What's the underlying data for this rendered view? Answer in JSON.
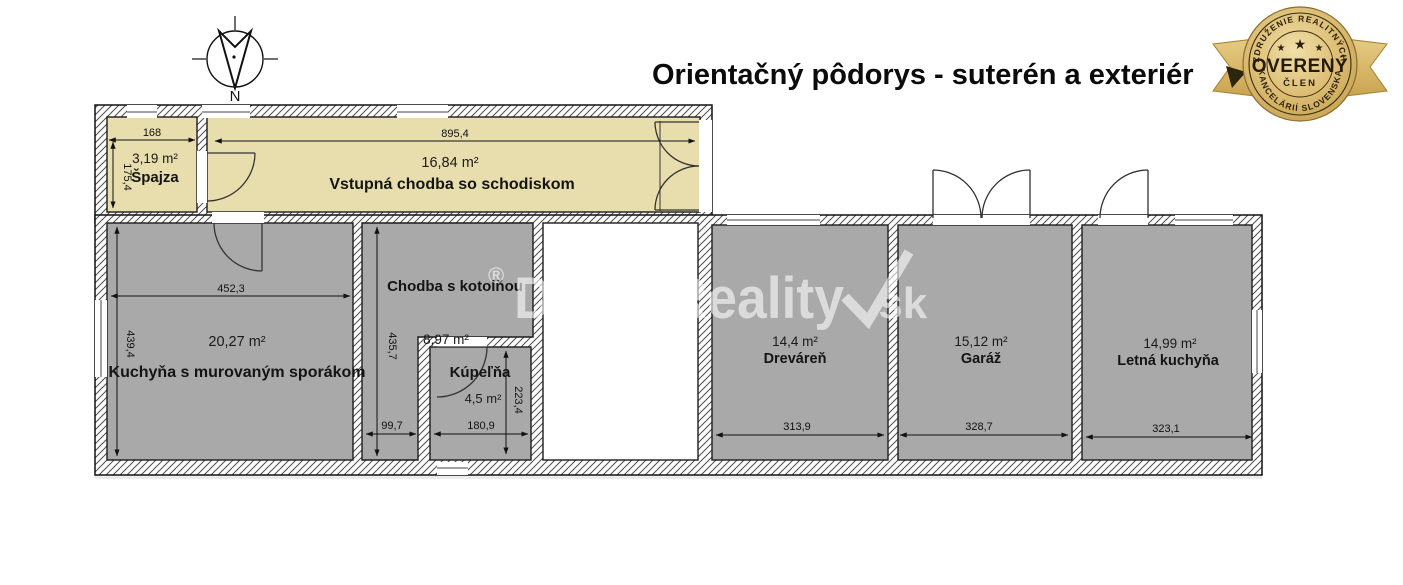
{
  "title": "Orientačný pôdorys - suterén a exteriér",
  "compass": {
    "north_label": "N"
  },
  "watermark": {
    "registered": "®",
    "text": "DobréReality",
    "suffix": ".sk"
  },
  "badge": {
    "top_arc": "ZDRUŽENIE REALITNÝCH",
    "bottom_arc": "KANCELÁRIÍ SLOVENSKA",
    "main_label": "OVERENÝ",
    "sub_label": "ČLEN",
    "stars": [
      "★",
      "★",
      "★"
    ]
  },
  "rooms": {
    "spajza": {
      "name": "Špajza",
      "area": "3,19 m²",
      "width": "168",
      "height": "175,4"
    },
    "hall": {
      "name": "Vstupná chodba so schodiskom",
      "area": "16,84 m²",
      "width": "895,4"
    },
    "kitchen": {
      "name": "Kuchyňa s murovaným sporákom",
      "area": "20,27 m²",
      "width": "452,3",
      "height": "439,4"
    },
    "chodba": {
      "name": "Chodba s kotolňou",
      "area": "8,97 m²",
      "width": "99,7",
      "height": "435,7"
    },
    "kupelna": {
      "name": "Kúpeľňa",
      "area": "4,5 m²",
      "width": "180,9",
      "height": "223,4"
    },
    "drevaren": {
      "name": "Dreváreň",
      "area": "14,4 m²",
      "width": "313,9"
    },
    "garaz": {
      "name": "Garáž",
      "area": "15,12 m²",
      "width": "328,7"
    },
    "letna": {
      "name": "Letná kuchyňa",
      "area": "14,99 m²",
      "width": "323,1"
    }
  },
  "colors": {
    "room_warm_fill": "#e8ddad",
    "room_gray_fill": "#a9a9a9",
    "badge_gold": "#d9b967",
    "line": "#111111"
  }
}
